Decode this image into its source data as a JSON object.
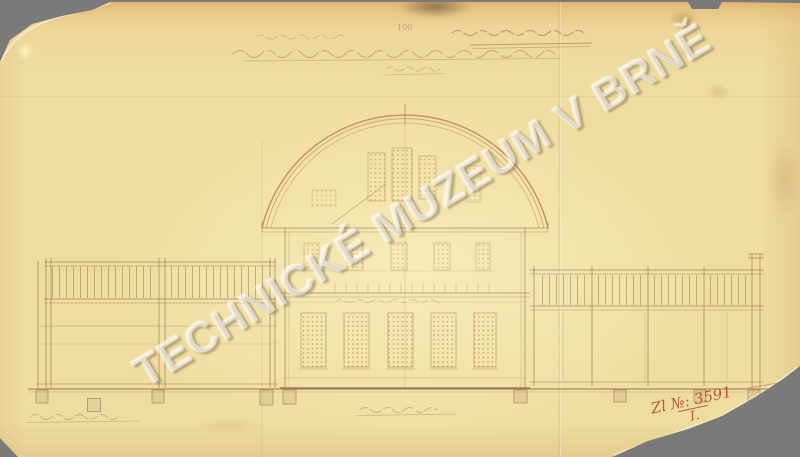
{
  "scan": {
    "watermark_text": "TECHNICKÉ MUZEUM V BRNĚ",
    "archive_number": "Zl №: 3591",
    "archive_series": "I.",
    "scale_note": "100",
    "colors": {
      "background_gray": "#7a7a78",
      "paper_aged_yellow": "#efdca0",
      "paper_top_tan": "#dea45e",
      "ink_sepia": "#a9774f",
      "dome_arc_red": "#b5714e",
      "inscription_red": "#b5452c",
      "watermark_white": "#ffffff"
    }
  }
}
